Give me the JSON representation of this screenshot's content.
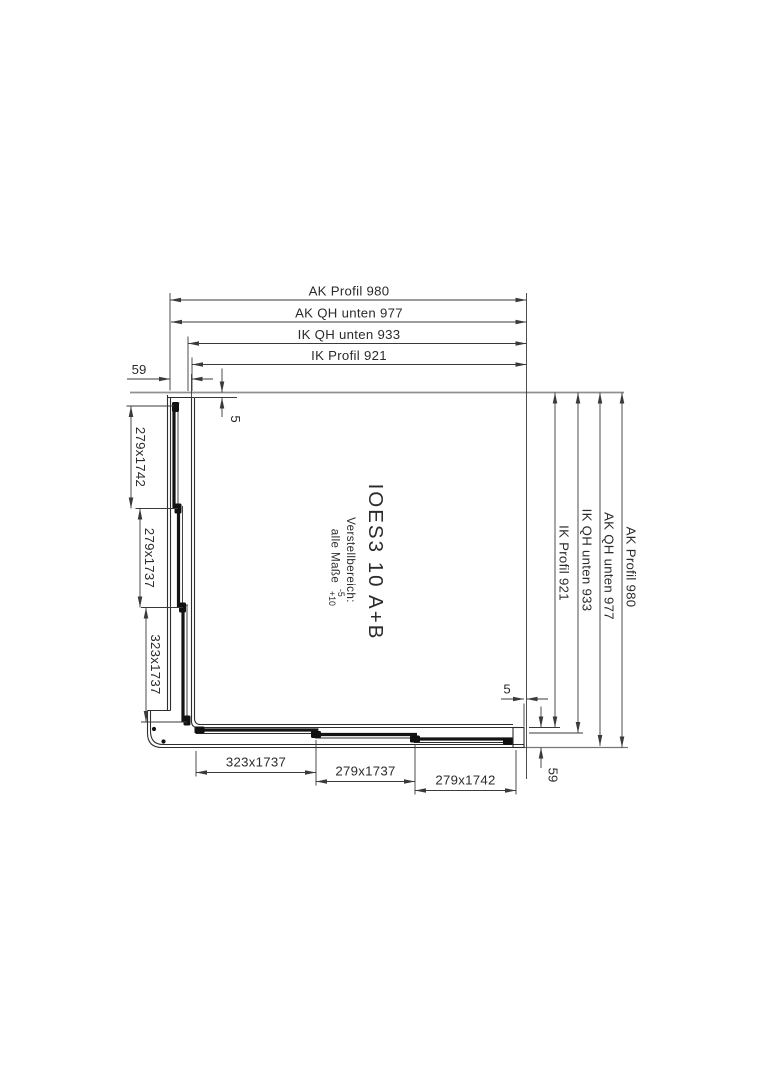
{
  "drawing": {
    "labels": {
      "title": "IOES3 10 A+B",
      "adjust_line1": "Verstellbereich:",
      "adjust_line2": "alle Maße",
      "adjust_minus": "-5",
      "adjust_plus": "+10"
    },
    "dimensions": {
      "top": [
        "AK Profil 980",
        "AK QH unten 977",
        "IK QH unten 933",
        "IK Profil 921"
      ],
      "right": [
        "IK Profil 921",
        "IK QH unten 933",
        "AK QH unten 977",
        "AK Profil 980"
      ],
      "left": [
        "279x1742",
        "279x1737",
        "323x1737"
      ],
      "bottom": [
        "323x1737",
        "279x1737",
        "279x1742"
      ],
      "small": {
        "top_offset": "59",
        "top_gap": "5",
        "bottom_gap": "5",
        "bottom_offset": "59"
      }
    },
    "colors": {
      "profile_line": "#2d2d2d",
      "dimension_line": "#3a3a3a",
      "wall_reference": "#8e9091",
      "glass": "#141414",
      "background": "#ffffff"
    }
  }
}
